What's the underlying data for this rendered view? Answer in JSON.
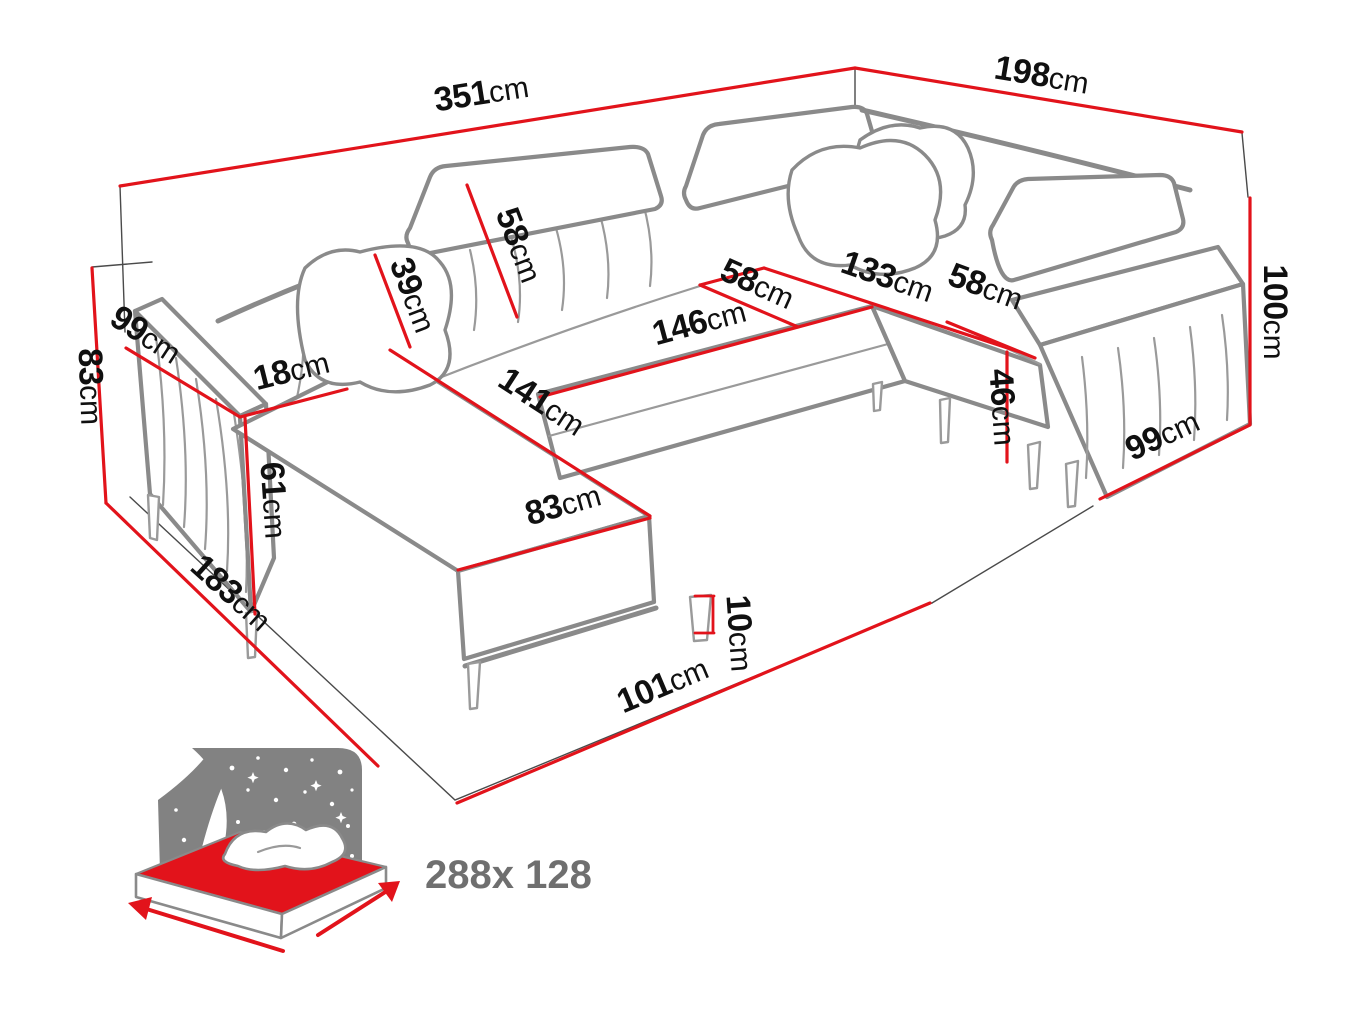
{
  "diagram": {
    "type": "sofa-dimension-diagram",
    "subject": "U-shaped corner sofa bed with measurement annotations",
    "colors": {
      "dimension_red": "#e2131b",
      "sofa_outline_gray": "#8a8a8a",
      "guide_line_dark": "#4a4a4a",
      "label_text": "#101010",
      "icon_gray": "#828282",
      "size_text_gray": "#6f6f6f"
    }
  },
  "dimensions": {
    "back_width": {
      "value": "351",
      "unit": "cm"
    },
    "right_depth": {
      "value": "198",
      "unit": "cm"
    },
    "total_height": {
      "value": "100",
      "unit": "cm"
    },
    "body_height": {
      "value": "83",
      "unit": "cm"
    },
    "left_arm_length": {
      "value": "99",
      "unit": "cm"
    },
    "arm_width": {
      "value": "18",
      "unit": "cm"
    },
    "arm_height": {
      "value": "61",
      "unit": "cm"
    },
    "left_side_depth": {
      "value": "183",
      "unit": "cm"
    },
    "chaise_length": {
      "value": "141",
      "unit": "cm"
    },
    "chaise_width": {
      "value": "83",
      "unit": "cm"
    },
    "headrest_height": {
      "value": "39",
      "unit": "cm"
    },
    "backrest_height": {
      "value": "58",
      "unit": "cm"
    },
    "middle_seat_width": {
      "value": "146",
      "unit": "cm"
    },
    "middle_seat_depth": {
      "value": "58",
      "unit": "cm"
    },
    "corner_seat_width": {
      "value": "133",
      "unit": "cm"
    },
    "right_seat_width": {
      "value": "58",
      "unit": "cm"
    },
    "seat_height": {
      "value": "46",
      "unit": "cm"
    },
    "right_arm_length": {
      "value": "99",
      "unit": "cm"
    },
    "leg_height": {
      "value": "10",
      "unit": "cm"
    },
    "front_clearance": {
      "value": "101",
      "unit": "cm"
    }
  },
  "sleeping_area": {
    "label": "288x 128"
  }
}
